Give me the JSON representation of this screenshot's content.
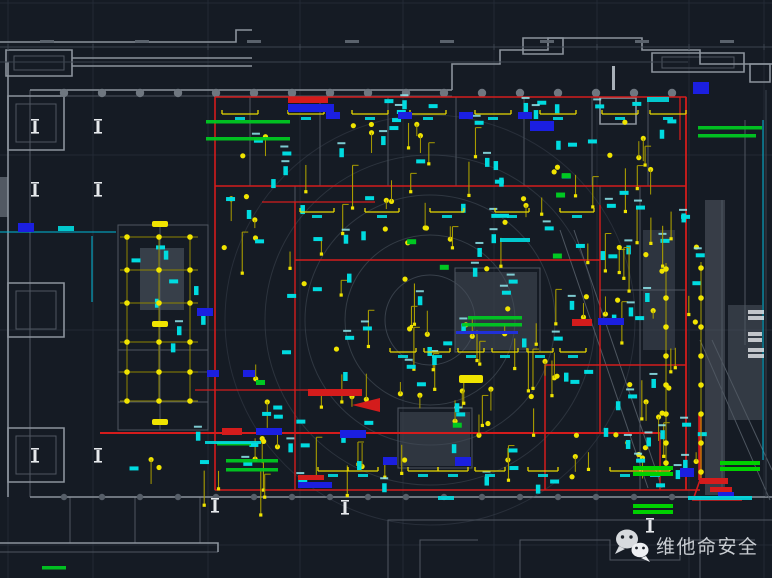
{
  "watermark": {
    "text": "维他命安全",
    "icon": "wechat-bubbles-icon",
    "color": "#c9cdd2"
  },
  "palette": {
    "bg": "#151b24",
    "grid": "#222a35",
    "wall_bright": "#8b939c",
    "wall_dim": "#4e5660",
    "wall_mid": "#6e7680",
    "red": "#d41c1c",
    "yellow": "#f0e400",
    "yellow_line": "#a89c00",
    "cyan": "#00dbe0",
    "cyan_dim": "#00b8d8",
    "blue": "#1b1fe0",
    "green": "#00c822",
    "white": "#e6e9ec",
    "gray_fill": "#49515b",
    "arc": "#47505b",
    "dim_string": "#3b434e",
    "dash": "#5a626c"
  },
  "canvas": {
    "w": 772,
    "h": 578
  },
  "grid": {
    "v": [
      8,
      93,
      208,
      300,
      403,
      494,
      597,
      689,
      764
    ],
    "h": [
      3,
      47,
      155,
      330,
      545
    ]
  },
  "fills": [
    [
      0,
      177,
      8,
      40,
      "#59606a",
      0.9
    ],
    [
      705,
      200,
      20,
      295,
      "#59606a",
      0.5
    ],
    [
      140,
      248,
      44,
      62,
      "#3d4550",
      0.85
    ],
    [
      455,
      272,
      82,
      78,
      "#3a424d",
      0.7
    ],
    [
      400,
      412,
      70,
      54,
      "#3a424d",
      0.7
    ],
    [
      643,
      230,
      32,
      120,
      "#3e4651",
      0.6
    ],
    [
      728,
      305,
      34,
      115,
      "#47505a",
      0.6
    ]
  ],
  "walls": {
    "dim": [
      "M30,96 H452",
      "M215,97 H686 V490 H215 Z",
      "M250,97 V186 M320,97 V186 M388,97 V186 M456,97 V186 M524,97 V186 M592,97 V186 M648,97 V186",
      "M295,186 V260 M600,186 V260",
      "M118,225 H208 V430 H118 Z",
      "M118,350 H208 M118,372 H208 M118,402 H208 M160,225 V430",
      "M455,268 H540 V352 H455 Z",
      "M398,408 H472 V468 H398 Z",
      "M640,186 V490 M600,290 H686",
      "M388,578 V520 H772",
      "M420,578 V540 H478",
      "M520,578 V540 H610 V560 H680 V540 H755",
      "M700,497 V578",
      "M70,497 V543 M135,497 V543 M200,497 V543",
      "M0,552 H218",
      "M745,120 V345",
      "M722,200 V497",
      "M30,90 V497",
      "M14,56 H64 V70 H14 Z",
      "M16,104 H56 V142 H16 Z",
      "M16,291 H56 V329 H16 Z",
      "M16,436 H56 V474 H16 Z",
      "M662,57 H734 V68 H662 Z"
    ],
    "bright": [
      "M0,42 H236 V30 H252",
      "M6,50 H72 V76 H6 Z",
      "M72,58 H252 M72,66 H252",
      "M8,96 H64 V150 H8 Z",
      "M8,283 H64 V337 H8 Z",
      "M8,428 H64 V482 H8 Z",
      "M8,62 V497",
      "M30,90 H452",
      "M452,90 V64 H500 V50 H548 V38 H642 V50 H700 V64 H772",
      "M652,53 H744 V72 H652 Z",
      "M523,38 H563 V54 H523 Z",
      "M750,64 H770 V82 H750 Z",
      "M30,497 H772",
      "M0,543 H218 V552",
      "M600,98 H636 V124 H600 Z"
    ]
  },
  "columns": {
    "top": {
      "y": 93,
      "x0": 64,
      "x1": 696,
      "step": 38,
      "r": 4.2
    },
    "bottom": {
      "y": 497,
      "x0": 64,
      "x1": 696,
      "step": 38,
      "r": 3.2
    }
  },
  "arcs": {
    "cx": 430,
    "cy": 320,
    "radii": [
      45,
      85,
      125,
      165,
      205
    ]
  },
  "diagonals": [
    "M560,230 L648,488",
    "M574,230 L662,488",
    "M700,340 L770,500",
    "M712,340 L772,470"
  ],
  "dims": {
    "strings": [
      "M0,47 H772",
      "M0,62 H688",
      "M766,90 V497"
    ],
    "dashes": [
      [
        40,
        40,
        14,
        3
      ],
      [
        135,
        40,
        14,
        3
      ],
      [
        247,
        40,
        14,
        3
      ],
      [
        345,
        40,
        14,
        3
      ],
      [
        440,
        40,
        14,
        3
      ],
      [
        540,
        40,
        14,
        3
      ],
      [
        635,
        40,
        14,
        3
      ],
      [
        720,
        40,
        14,
        3
      ]
    ],
    "cyan_lines": [
      [
        0,
        232,
        116,
        232
      ],
      [
        92,
        236,
        92,
        302
      ],
      [
        763,
        120,
        763,
        460
      ]
    ]
  },
  "red_paths": [
    {
      "d": "M215,97 H686",
      "w": 1.6
    },
    {
      "d": "M215,97 V490",
      "w": 1.6
    },
    {
      "d": "M215,186 H686",
      "w": 1.4
    },
    {
      "d": "M215,490 H700",
      "w": 1.6
    },
    {
      "d": "M262,202 H375",
      "w": 1.2
    },
    {
      "d": "M295,202 V490",
      "w": 1.4
    },
    {
      "d": "M295,260 H600",
      "w": 1.6
    },
    {
      "d": "M600,205 V433",
      "w": 1.4
    },
    {
      "d": "M686,97 V490",
      "w": 1.8
    },
    {
      "d": "M545,365 H686",
      "w": 1.5
    },
    {
      "d": "M545,365 V490",
      "w": 1.5
    },
    {
      "d": "M100,433 H660",
      "w": 2
    },
    {
      "d": "M660,433 V490",
      "w": 1.4
    },
    {
      "d": "M195,390 H310",
      "w": 1.3
    },
    {
      "d": "M700,415 V480",
      "w": 3.6
    },
    {
      "d": "M700,480 L693,500 H742",
      "w": 1.6
    },
    {
      "d": "M680,97 V140",
      "w": 1.3
    }
  ],
  "bars": {
    "red": [
      [
        288,
        97,
        40,
        6
      ],
      [
        308,
        389,
        54,
        7
      ],
      [
        572,
        319,
        20,
        7
      ],
      [
        222,
        428,
        20,
        7
      ],
      [
        298,
        475,
        26,
        5
      ],
      [
        700,
        478,
        28,
        6
      ],
      [
        710,
        487,
        22,
        5
      ]
    ],
    "red_arrow": [
      [
        352,
        405
      ],
      [
        380,
        398
      ],
      [
        380,
        412
      ]
    ],
    "blue": [
      [
        288,
        104,
        46,
        8
      ],
      [
        530,
        121,
        24,
        10
      ],
      [
        693,
        82,
        16,
        12
      ],
      [
        18,
        223,
        16,
        9
      ],
      [
        298,
        482,
        34,
        6
      ],
      [
        680,
        468,
        14,
        9
      ],
      [
        718,
        492,
        16,
        6
      ],
      [
        340,
        430,
        26,
        8
      ],
      [
        383,
        457,
        14,
        8
      ],
      [
        455,
        457,
        16,
        9
      ],
      [
        598,
        318,
        26,
        7
      ],
      [
        197,
        308,
        16,
        8
      ],
      [
        256,
        428,
        26,
        7
      ],
      [
        207,
        370,
        12,
        7
      ],
      [
        243,
        370,
        12,
        7
      ],
      [
        326,
        112,
        14,
        7
      ],
      [
        398,
        112,
        14,
        7
      ],
      [
        459,
        112,
        14,
        7
      ],
      [
        518,
        112,
        14,
        7
      ]
    ],
    "yellow_pills": [
      [
        152,
        221,
        16,
        6
      ],
      [
        152,
        321,
        16,
        6
      ],
      [
        152,
        419,
        16,
        6
      ],
      [
        459,
        375,
        24,
        8
      ]
    ]
  },
  "brackets": [
    {
      "y": 114,
      "w": 36,
      "xs": [
        222,
        288,
        352,
        410,
        475,
        540,
        602,
        650
      ]
    },
    {
      "y": 212,
      "w": 34,
      "xs": [
        300,
        365,
        430,
        495,
        560
      ]
    },
    {
      "y": 352,
      "w": 26,
      "xs": [
        390,
        424,
        458,
        492,
        527,
        560
      ]
    },
    {
      "y": 471,
      "w": 30,
      "xs": [
        318,
        348,
        408,
        438,
        475,
        528,
        610,
        640
      ]
    }
  ],
  "room_grid": {
    "cols": [
      127,
      159,
      190
    ],
    "rows": [
      237,
      270,
      303,
      342,
      372,
      401
    ]
  },
  "dot_strings": [
    {
      "x": 701,
      "ys": [
        268,
        298,
        327,
        356,
        385,
        414,
        443,
        472
      ]
    },
    {
      "x": 666,
      "ys": [
        269,
        298,
        327,
        356,
        385,
        414,
        443,
        463
      ]
    }
  ],
  "clusters": [
    {
      "t": "ydot",
      "x": 222,
      "y": 120,
      "w": 430,
      "h": 60,
      "n": 14
    },
    {
      "t": "yline",
      "x": 228,
      "y": 118,
      "w": 420,
      "h": 62,
      "n": 12
    },
    {
      "t": "cchip",
      "x": 222,
      "y": 118,
      "w": 450,
      "h": 64,
      "n": 20
    },
    {
      "t": "ydot",
      "x": 222,
      "y": 192,
      "w": 450,
      "h": 64,
      "n": 16
    },
    {
      "t": "yline",
      "x": 228,
      "y": 190,
      "w": 440,
      "h": 64,
      "n": 12
    },
    {
      "t": "cchip",
      "x": 222,
      "y": 190,
      "w": 460,
      "h": 66,
      "n": 22
    },
    {
      "t": "ydot",
      "x": 250,
      "y": 268,
      "w": 340,
      "h": 158,
      "n": 26
    },
    {
      "t": "yline",
      "x": 255,
      "y": 266,
      "w": 330,
      "h": 158,
      "n": 20
    },
    {
      "t": "cchip",
      "x": 248,
      "y": 266,
      "w": 350,
      "h": 160,
      "n": 30
    },
    {
      "t": "ydot",
      "x": 605,
      "y": 205,
      "w": 92,
      "h": 275,
      "n": 15
    },
    {
      "t": "yline",
      "x": 608,
      "y": 205,
      "w": 85,
      "h": 270,
      "n": 10
    },
    {
      "t": "cchip",
      "x": 603,
      "y": 202,
      "w": 96,
      "h": 278,
      "n": 16
    },
    {
      "t": "ydot",
      "x": 115,
      "y": 432,
      "w": 540,
      "h": 52,
      "n": 16
    },
    {
      "t": "yline",
      "x": 120,
      "y": 430,
      "w": 530,
      "h": 52,
      "n": 12
    },
    {
      "t": "cchip",
      "x": 115,
      "y": 430,
      "w": 560,
      "h": 56,
      "n": 22
    },
    {
      "t": "cchip",
      "x": 122,
      "y": 230,
      "w": 80,
      "h": 118,
      "n": 9
    },
    {
      "t": "gchip",
      "x": 250,
      "y": 120,
      "w": 420,
      "h": 330,
      "n": 7
    },
    {
      "t": "cchip",
      "x": 300,
      "y": 95,
      "w": 350,
      "h": 16,
      "n": 10
    }
  ],
  "green": {
    "lines": [
      [
        206,
        120,
        84
      ],
      [
        206,
        137,
        84
      ],
      [
        698,
        126,
        64
      ],
      [
        698,
        134,
        58
      ],
      [
        468,
        316,
        54
      ],
      [
        462,
        323,
        60
      ],
      [
        226,
        459,
        52
      ],
      [
        226,
        468,
        52
      ],
      [
        42,
        566,
        24
      ],
      [
        217,
        442,
        34
      ]
    ],
    "underline": [
      456,
      331,
      62,
      3
    ],
    "pairs": [
      [
        633,
        466,
        40
      ],
      [
        633,
        472,
        40
      ],
      [
        720,
        461,
        40
      ],
      [
        720,
        467,
        40
      ],
      [
        633,
        504,
        40
      ],
      [
        633,
        510,
        40
      ]
    ]
  },
  "cyan_labels": [
    [
      647,
      97,
      22,
      5
    ],
    [
      438,
      496,
      16,
      4
    ],
    [
      205,
      441,
      56,
      3
    ],
    [
      688,
      496,
      64,
      4
    ],
    [
      58,
      226,
      16,
      5
    ],
    [
      500,
      238,
      30,
      4
    ]
  ],
  "white": {
    "marks": [
      [
        35,
        121
      ],
      [
        98,
        121
      ],
      [
        35,
        184
      ],
      [
        98,
        184
      ],
      [
        35,
        450
      ],
      [
        98,
        450
      ],
      [
        215,
        500
      ],
      [
        345,
        502
      ],
      [
        650,
        520
      ]
    ],
    "labels": [
      [
        748,
        310,
        16,
        4
      ],
      [
        748,
        316,
        16,
        4
      ],
      [
        748,
        332,
        14,
        4
      ],
      [
        748,
        338,
        14,
        4
      ],
      [
        748,
        348,
        16,
        4
      ],
      [
        748,
        354,
        16,
        4
      ]
    ],
    "tick": [
      612,
      66,
      3,
      24
    ]
  }
}
